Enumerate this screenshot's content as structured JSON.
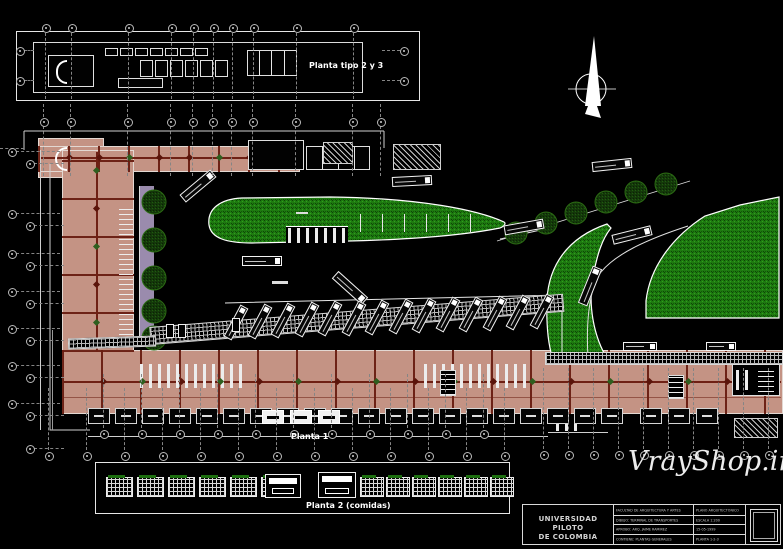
{
  "page": {
    "type": "cad-architectural-drawing",
    "background": "#000000"
  },
  "plans": {
    "typical_floor": {
      "label": "Planta tipo 2 y 3"
    },
    "ground_floor": {
      "label": "Planta 1"
    },
    "food_floor": {
      "label": "Planta 2 (comidas)"
    }
  },
  "title_block": {
    "institution": "UNIVERSIDAD PILOTO DE COLOMBIA",
    "institution_line1": "UNIVERSIDAD PILOTO",
    "institution_line2": "DE COLOMBIA",
    "note": "small text approximate (illegible in source)",
    "info_rows": [
      {
        "label": "FACULTAD DE ARQUITECTURA Y ARTES",
        "value": "PLANO ARQUITECTONICO"
      },
      {
        "label": "DIBUJO: TERMINAL DE TRANSPORTES",
        "value": "ESCALA 1:200"
      },
      {
        "label": "APROBO: ARQ. JAIME RAMIREZ",
        "value": "15-05-1999"
      },
      {
        "label": "CONTIENE: PLANTAS GENERALES",
        "value": "PLANTA 1-2-3"
      }
    ]
  },
  "watermark": "VrayShop.ir",
  "symbols": {
    "north_arrow": "north-arrow",
    "grid_bubble": "column-grid-marker",
    "tree": "site-tree",
    "bus": "bus-plan-view"
  },
  "site": {
    "diagonal_tree_count": 6,
    "walkway_tree_count": 5,
    "bus_bay_count": 14
  },
  "colors": {
    "floor_salmon": "#c49384",
    "structure_red": "#6e2014",
    "lawn_green": "#1e7a10",
    "tree_green": "#14380a",
    "walkway_lavender": "#9a8bad",
    "line_white": "#ffffff"
  }
}
